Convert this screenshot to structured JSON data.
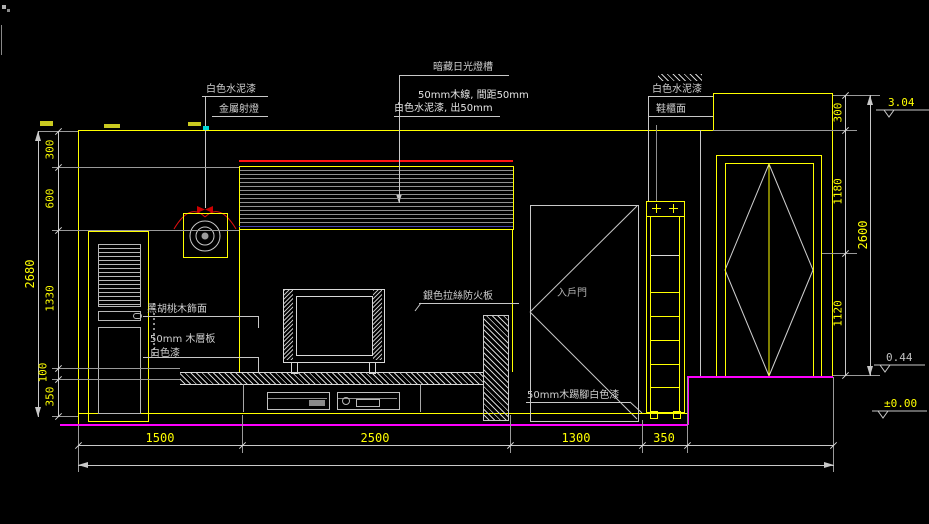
{
  "drawing_labels": {
    "white_cement_left": "白色水泥漆",
    "metal_spotlight": "金屬射燈",
    "hidden_fluorescent": "暗藏日光燈槽",
    "wood_strip_spec": "50mm木線, 間距50mm",
    "white_cement_out": "白色水泥漆, 出50mm",
    "white_cement_right": "白色水泥漆",
    "shoe_cabinet_face": "鞋櫃面",
    "walnut_veneer": "黑胡桃木飾面",
    "wood_shelf": "50mm 木層板",
    "white_paint": "白色漆",
    "fireproof_board": "銀色拉絲防火板",
    "entry_door": "入戶門",
    "skirting": "50mm木踢腳白色漆"
  },
  "dimensions": {
    "left": {
      "overall": "2680",
      "segments": [
        "300",
        "600",
        "1330",
        "100",
        "350"
      ]
    },
    "right": {
      "overall": "2600",
      "segments": [
        "300",
        "1180",
        "1120"
      ]
    },
    "bottom": {
      "segments": [
        "1500",
        "2500",
        "1300",
        "350"
      ]
    },
    "levels": {
      "ceiling": "3.04",
      "step": "0.44",
      "floor": "±0.00"
    }
  },
  "colors": {
    "background": "#000000",
    "line_yellow": "#ffff00",
    "line_gray": "#c8c8c8",
    "floor_magenta": "#ff00ff",
    "lamp_red": "#ff0000",
    "dim_text": "#ffff00"
  }
}
